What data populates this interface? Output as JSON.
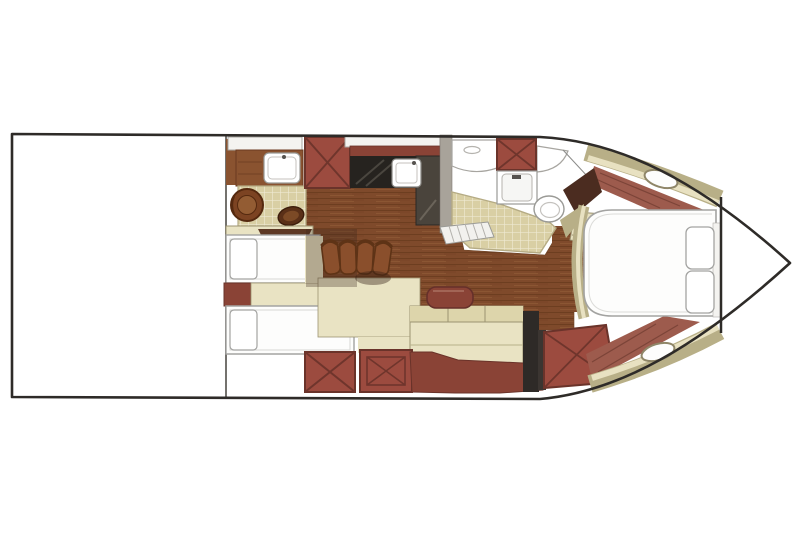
{
  "figure": {
    "type": "floor-plan",
    "subject": "motor-yacht lower deck accommodation plan, bow pointing right",
    "view": "top-down"
  },
  "regions": [
    "aft-cockpit-undetailed",
    "aft-head-with-shower-seat",
    "galley-counter-with-sink",
    "mid-cabin-twin-berths",
    "dinette-with-four-chairs",
    "salon-sofa",
    "forward-head-with-toilet-and-vanity",
    "companionway-steps",
    "bow-cabin-island-berth",
    "anchor-locker",
    "deck-hatches"
  ],
  "palette": {
    "background": "#ffffff",
    "hull_outline": "#2e2b28",
    "inner_line": "#74726e",
    "panel_white": "#f4f3f0",
    "wood": "#7f4a2b",
    "wood_dark": "#5f3418",
    "wood_light": "#95603a",
    "cabinet_wood": "#8a5330",
    "maroon": "#9c4b3f",
    "maroon_dark": "#6a332a",
    "maroon_band": "#8a4336",
    "bow_floor": "#9d5b4d",
    "counter_black": "#26231f",
    "appliance_gray": "#4a443c",
    "wall_gray": "#a8a39a",
    "tile": "#d9cfa4",
    "tile_grout": "#efe9d2",
    "beige": "#e9e3c3",
    "beige_dark": "#ddd5ab",
    "beige_border": "#9c9372",
    "khaki": "#b8af87",
    "cream": "#e8e1c1",
    "bed_white": "#fdfdfc",
    "bed_border": "#a3a3a1",
    "chair_brown": "#8a4f2c",
    "chair_dark": "#5e3316",
    "shadow": "rgba(55,38,28,0.30)"
  }
}
